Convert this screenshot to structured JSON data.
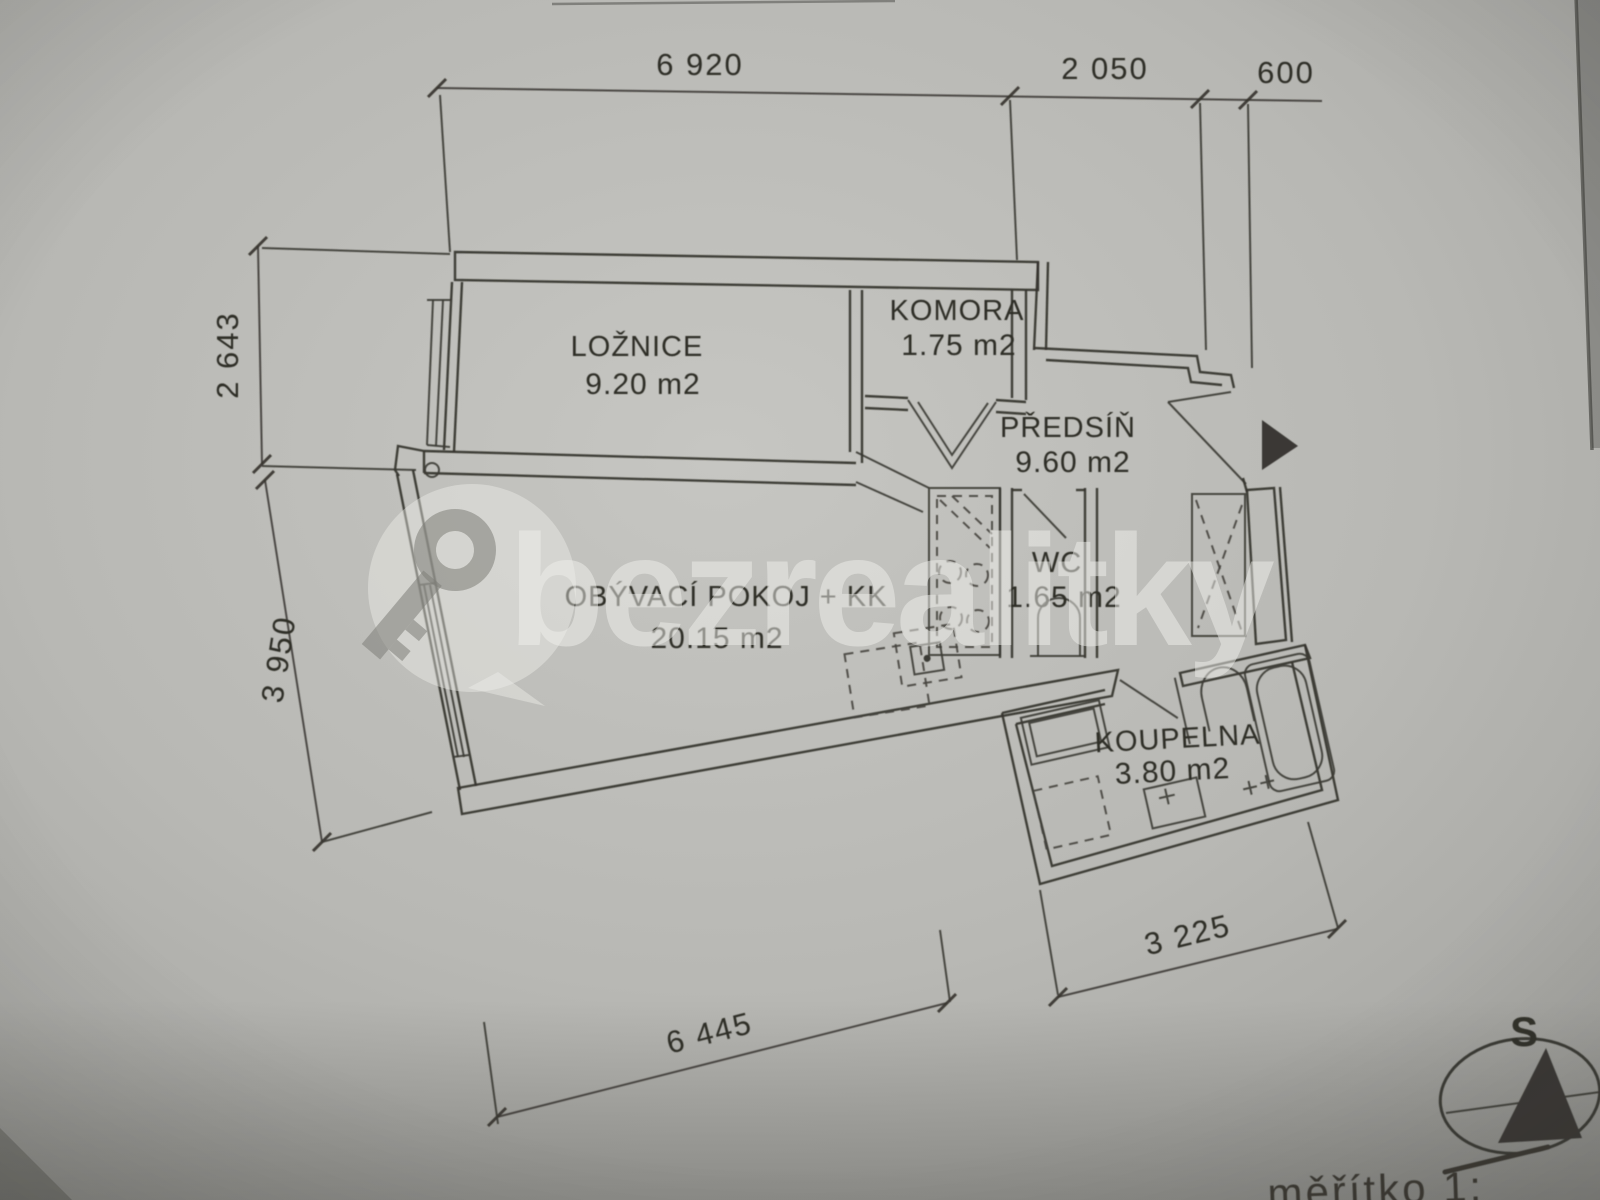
{
  "watermark": {
    "brand": "bezrealitky",
    "icon": "key-icon"
  },
  "rooms": [
    {
      "name": "LOŽNICE",
      "area": "9.20 m2"
    },
    {
      "name": "KOMORA",
      "area": "1.75 m2"
    },
    {
      "name": "PŘEDSÍŇ",
      "area": "9.60 m2"
    },
    {
      "name": "OBÝVACÍ POKOJ + KK",
      "area": "20.15 m2"
    },
    {
      "name": "WC",
      "area": "1.65 m2"
    },
    {
      "name": "KOUPELNA",
      "area": "3.80 m2"
    }
  ],
  "dimensions": {
    "top": [
      "6 920",
      "2 050",
      "600"
    ],
    "left": [
      "2 643",
      "3 950"
    ],
    "bottom": [
      "6 445",
      "3 225"
    ]
  },
  "compass": {
    "north_label": "S"
  },
  "scale_note": "měřítko  1:"
}
